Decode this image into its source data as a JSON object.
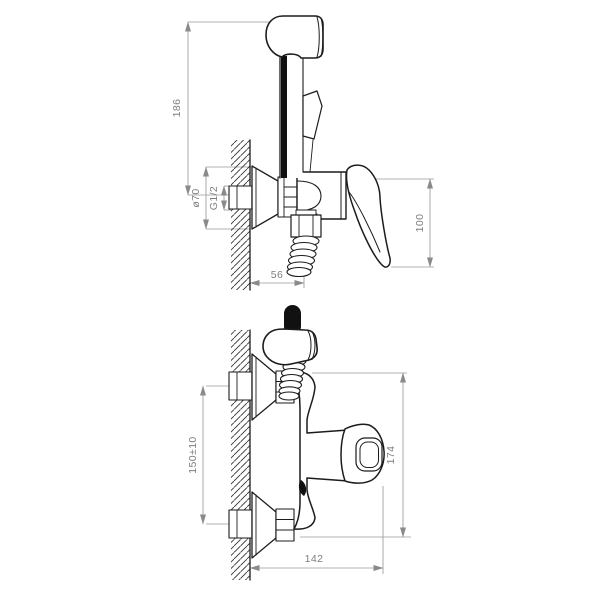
{
  "diagram": {
    "type": "technical-drawing",
    "subject": "Wall-mounted mixer with hygienic hand sprayer - installation drawing",
    "units": "mm",
    "colors": {
      "background": "#ffffff",
      "outline": "#1c1c1c",
      "dimension_lines": "#9a9a9a",
      "dimension_text": "#7e7e7e"
    },
    "views": [
      {
        "id": "side-view",
        "name": "side profile view",
        "dimensions": [
          {
            "id": "overall-height",
            "label": "186",
            "orientation": "vertical"
          },
          {
            "id": "escutcheon-diameter",
            "label": "ø70",
            "orientation": "vertical"
          },
          {
            "id": "connection-thread",
            "label": "G1/2",
            "orientation": "vertical"
          },
          {
            "id": "lever-height",
            "label": "100",
            "orientation": "vertical"
          },
          {
            "id": "wall-projection",
            "label": "56",
            "orientation": "horizontal"
          }
        ]
      },
      {
        "id": "front-view",
        "name": "front view",
        "dimensions": [
          {
            "id": "connection-centers",
            "label": "150±10",
            "orientation": "vertical"
          },
          {
            "id": "overall-height",
            "label": "174",
            "orientation": "vertical"
          },
          {
            "id": "overall-width",
            "label": "142",
            "orientation": "horizontal"
          }
        ]
      }
    ]
  }
}
